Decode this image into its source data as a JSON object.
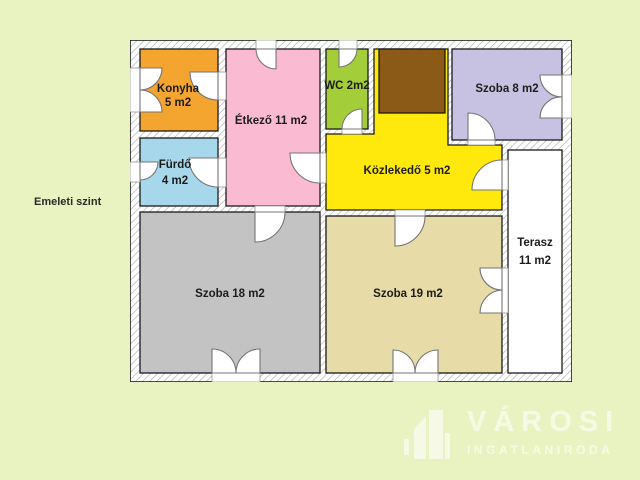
{
  "page": {
    "background_color": "#e9f3c2",
    "floor_label": "Emeleti szint",
    "label_color": "#1c1c1c"
  },
  "plan": {
    "wall_fill": "#ffffff",
    "wall_hatch_color": "#a9a9a9",
    "outline_color": "#1a1a1a",
    "rooms": {
      "konyha": {
        "name": "Konyha",
        "area": "5 m2",
        "color": "#f3a52f"
      },
      "furdo": {
        "name": "Fürdő",
        "area": "4 m2",
        "color": "#a6d7ea"
      },
      "etkezo": {
        "label": "Étkező 11 m2",
        "color": "#f9bad2"
      },
      "wc": {
        "label": "WC 2m2",
        "color": "#a3cd39"
      },
      "szoba8": {
        "label": "Szoba 8 m2",
        "color": "#c7c2e2"
      },
      "kozlekedo": {
        "label": "Közlekedő 5 m2",
        "color": "#ffe90c"
      },
      "terasz": {
        "name": "Terasz",
        "area": "11 m2",
        "color": "#ffffff"
      },
      "szoba18": {
        "label": "Szoba 18 m2",
        "color": "#c3c3c3"
      },
      "szoba19": {
        "label": "Szoba 19 m2",
        "color": "#e7dba7"
      },
      "stairwell": {
        "color": "#8c5a17"
      }
    }
  },
  "logo": {
    "brand": "VÁROSI",
    "subtitle": "INGATLANIRODA"
  }
}
